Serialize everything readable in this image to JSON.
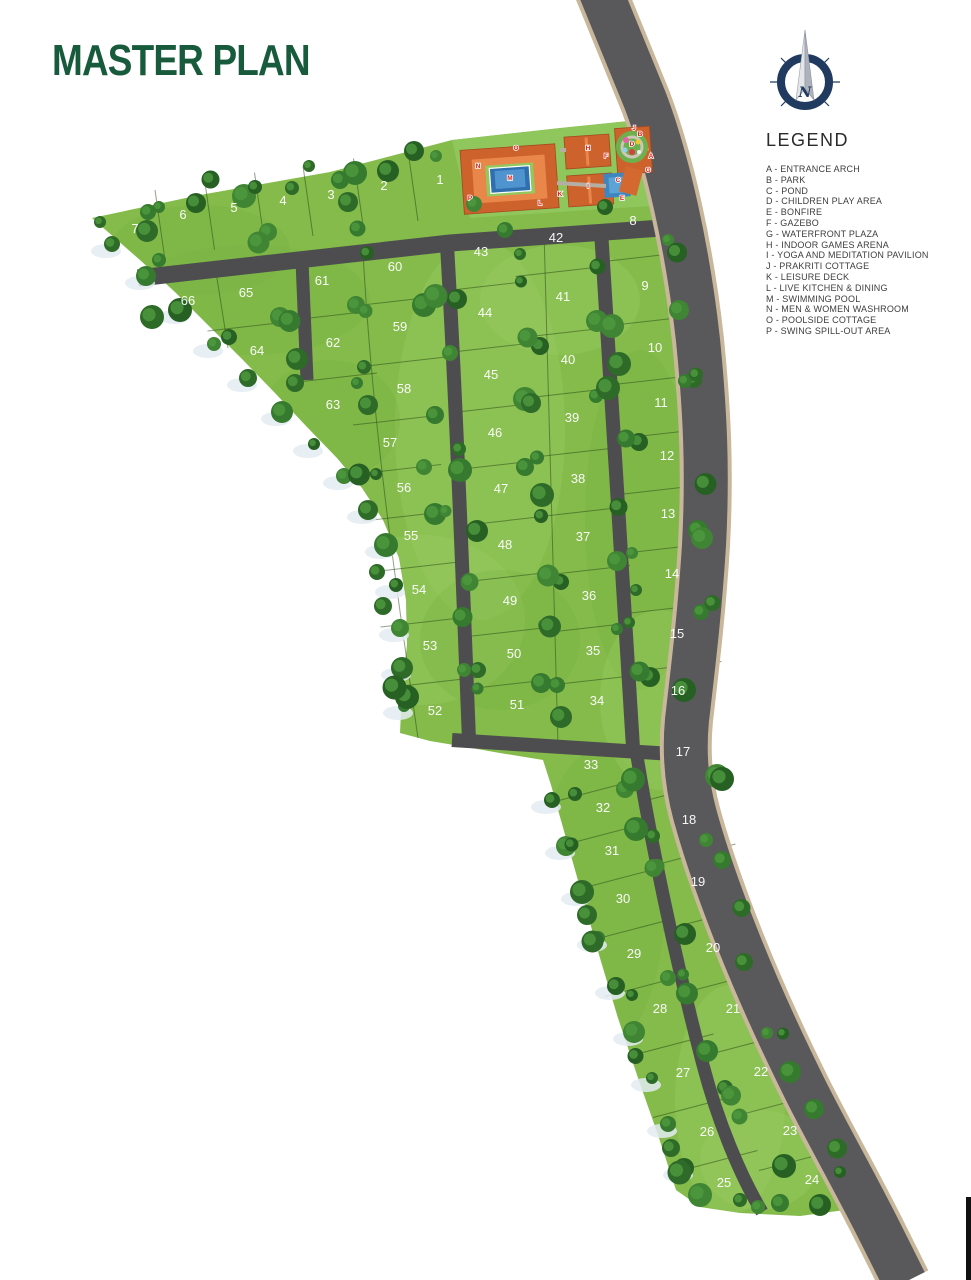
{
  "title": "MASTER PLAN",
  "compass": {
    "label": "N"
  },
  "legend": {
    "title": "LEGEND",
    "items": [
      {
        "key": "A",
        "label": "ENTRANCE ARCH"
      },
      {
        "key": "B",
        "label": "PARK"
      },
      {
        "key": "C",
        "label": "POND"
      },
      {
        "key": "D",
        "label": "CHILDREN PLAY AREA"
      },
      {
        "key": "E",
        "label": "BONFIRE"
      },
      {
        "key": "F",
        "label": "GAZEBO"
      },
      {
        "key": "G",
        "label": "WATERFRONT PLAZA"
      },
      {
        "key": "H",
        "label": "INDOOR GAMES ARENA"
      },
      {
        "key": "I",
        "label": "YOGA AND MEDITATION PAVILION"
      },
      {
        "key": "J",
        "label": "PRAKRITI COTTAGE"
      },
      {
        "key": "K",
        "label": "LEISURE DECK"
      },
      {
        "key": "L",
        "label": "LIVE KITCHEN & DINING"
      },
      {
        "key": "M",
        "label": "SWIMMING POOL"
      },
      {
        "key": "N",
        "label": "MEN & WOMEN WASHROOM"
      },
      {
        "key": "O",
        "label": "POOLSIDE COTTAGE"
      },
      {
        "key": "P",
        "label": "SWING SPILL-OUT AREA"
      }
    ]
  },
  "map": {
    "colors": {
      "site": "#84bb4b",
      "amenity_lawn": "#8fc75c",
      "main_road": "#59595b",
      "road_edge": "#c9b79b",
      "inner_road": "#4d4d4f",
      "plot_label": "#ffffff",
      "marker": "#d81f1c",
      "building_roof": "#cd622d",
      "pool": "#2f6fae"
    },
    "plots": [
      {
        "n": "1",
        "x": 440,
        "y": 184
      },
      {
        "n": "2",
        "x": 384,
        "y": 190
      },
      {
        "n": "3",
        "x": 331,
        "y": 199
      },
      {
        "n": "4",
        "x": 283,
        "y": 205
      },
      {
        "n": "5",
        "x": 234,
        "y": 212
      },
      {
        "n": "6",
        "x": 183,
        "y": 219
      },
      {
        "n": "7",
        "x": 135,
        "y": 233
      },
      {
        "n": "8",
        "x": 633,
        "y": 225
      },
      {
        "n": "9",
        "x": 645,
        "y": 290
      },
      {
        "n": "10",
        "x": 655,
        "y": 352
      },
      {
        "n": "11",
        "x": 661,
        "y": 407
      },
      {
        "n": "12",
        "x": 667,
        "y": 460
      },
      {
        "n": "13",
        "x": 668,
        "y": 518
      },
      {
        "n": "14",
        "x": 672,
        "y": 578
      },
      {
        "n": "15",
        "x": 677,
        "y": 638
      },
      {
        "n": "16",
        "x": 678,
        "y": 695
      },
      {
        "n": "17",
        "x": 683,
        "y": 756
      },
      {
        "n": "18",
        "x": 689,
        "y": 824
      },
      {
        "n": "19",
        "x": 698,
        "y": 886
      },
      {
        "n": "20",
        "x": 713,
        "y": 952
      },
      {
        "n": "21",
        "x": 733,
        "y": 1013
      },
      {
        "n": "22",
        "x": 761,
        "y": 1076
      },
      {
        "n": "23",
        "x": 790,
        "y": 1135
      },
      {
        "n": "24",
        "x": 812,
        "y": 1184
      },
      {
        "n": "25",
        "x": 724,
        "y": 1187
      },
      {
        "n": "26",
        "x": 707,
        "y": 1136
      },
      {
        "n": "27",
        "x": 683,
        "y": 1077
      },
      {
        "n": "28",
        "x": 660,
        "y": 1013
      },
      {
        "n": "29",
        "x": 634,
        "y": 958
      },
      {
        "n": "30",
        "x": 623,
        "y": 903
      },
      {
        "n": "31",
        "x": 612,
        "y": 855
      },
      {
        "n": "32",
        "x": 603,
        "y": 812
      },
      {
        "n": "33",
        "x": 591,
        "y": 769
      },
      {
        "n": "34",
        "x": 597,
        "y": 705
      },
      {
        "n": "35",
        "x": 593,
        "y": 655
      },
      {
        "n": "36",
        "x": 589,
        "y": 600
      },
      {
        "n": "37",
        "x": 583,
        "y": 541
      },
      {
        "n": "38",
        "x": 578,
        "y": 483
      },
      {
        "n": "39",
        "x": 572,
        "y": 422
      },
      {
        "n": "40",
        "x": 568,
        "y": 364
      },
      {
        "n": "41",
        "x": 563,
        "y": 301
      },
      {
        "n": "42",
        "x": 556,
        "y": 242
      },
      {
        "n": "43",
        "x": 481,
        "y": 256
      },
      {
        "n": "44",
        "x": 485,
        "y": 317
      },
      {
        "n": "45",
        "x": 491,
        "y": 379
      },
      {
        "n": "46",
        "x": 495,
        "y": 437
      },
      {
        "n": "47",
        "x": 501,
        "y": 493
      },
      {
        "n": "48",
        "x": 505,
        "y": 549
      },
      {
        "n": "49",
        "x": 510,
        "y": 605
      },
      {
        "n": "50",
        "x": 514,
        "y": 658
      },
      {
        "n": "51",
        "x": 517,
        "y": 709
      },
      {
        "n": "52",
        "x": 435,
        "y": 715
      },
      {
        "n": "53",
        "x": 430,
        "y": 650
      },
      {
        "n": "54",
        "x": 419,
        "y": 594
      },
      {
        "n": "55",
        "x": 411,
        "y": 540
      },
      {
        "n": "56",
        "x": 404,
        "y": 492
      },
      {
        "n": "57",
        "x": 390,
        "y": 447
      },
      {
        "n": "58",
        "x": 404,
        "y": 393
      },
      {
        "n": "59",
        "x": 400,
        "y": 331
      },
      {
        "n": "60",
        "x": 395,
        "y": 271
      },
      {
        "n": "61",
        "x": 322,
        "y": 285
      },
      {
        "n": "62",
        "x": 333,
        "y": 347
      },
      {
        "n": "63",
        "x": 333,
        "y": 409
      },
      {
        "n": "64",
        "x": 257,
        "y": 355
      },
      {
        "n": "65",
        "x": 246,
        "y": 297
      },
      {
        "n": "66",
        "x": 188,
        "y": 305
      }
    ],
    "divider_groups": [
      {
        "type": "v",
        "plots": [
          7,
          6,
          5,
          4,
          3,
          2,
          1
        ]
      },
      {
        "type": "h",
        "plots": [
          60,
          59,
          58,
          57,
          56,
          55,
          54,
          53,
          52
        ]
      },
      {
        "type": "h",
        "plots": [
          61,
          62,
          63
        ]
      },
      {
        "type": "h",
        "plots": [
          65,
          64
        ]
      },
      {
        "type": "h",
        "plots": [
          43,
          44,
          45,
          46,
          47,
          48,
          49,
          50,
          51
        ]
      },
      {
        "type": "h",
        "plots": [
          42,
          41,
          40,
          39,
          38,
          37,
          36,
          35,
          34
        ]
      },
      {
        "type": "h",
        "plots": [
          8,
          9,
          10,
          11,
          12,
          13,
          14,
          15,
          16
        ]
      },
      {
        "type": "hs",
        "plots": [
          17,
          18,
          19,
          20,
          21,
          22,
          23,
          24
        ]
      },
      {
        "type": "hs",
        "plots": [
          33,
          32,
          31,
          30,
          29,
          28,
          27,
          26,
          25
        ]
      }
    ],
    "amenity_markers": [
      {
        "key": "A",
        "x": 651,
        "y": 158
      },
      {
        "key": "B",
        "x": 640,
        "y": 136
      },
      {
        "key": "C",
        "x": 618,
        "y": 182
      },
      {
        "key": "D",
        "x": 632,
        "y": 146
      },
      {
        "key": "E",
        "x": 622,
        "y": 200
      },
      {
        "key": "F",
        "x": 606,
        "y": 158
      },
      {
        "key": "G",
        "x": 648,
        "y": 172
      },
      {
        "key": "H",
        "x": 588,
        "y": 150
      },
      {
        "key": "I",
        "x": 588,
        "y": 188
      },
      {
        "key": "J",
        "x": 634,
        "y": 130
      },
      {
        "key": "K",
        "x": 560,
        "y": 196
      },
      {
        "key": "L",
        "x": 540,
        "y": 205
      },
      {
        "key": "M",
        "x": 510,
        "y": 180
      },
      {
        "key": "N",
        "x": 478,
        "y": 168
      },
      {
        "key": "O",
        "x": 516,
        "y": 150
      },
      {
        "key": "P",
        "x": 470,
        "y": 200
      }
    ]
  }
}
